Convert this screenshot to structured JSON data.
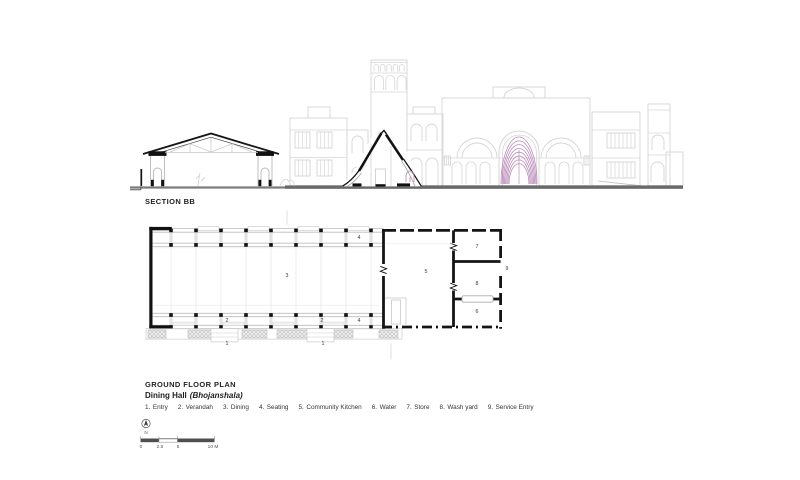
{
  "section": {
    "title": "SECTION BB"
  },
  "plan": {
    "title": "GROUND FLOOR PLAN",
    "subtitle_bold": "Dining Hall",
    "subtitle_italic": "(Bhojanshala)",
    "room_labels": [
      {
        "n": "4",
        "x": 359,
        "y": 238
      },
      {
        "n": "3",
        "x": 287,
        "y": 276
      },
      {
        "n": "5",
        "x": 426,
        "y": 272
      },
      {
        "n": "7",
        "x": 477,
        "y": 247
      },
      {
        "n": "9",
        "x": 507,
        "y": 269
      },
      {
        "n": "8",
        "x": 477,
        "y": 284
      },
      {
        "n": "6",
        "x": 477,
        "y": 312
      },
      {
        "n": "2",
        "x": 227,
        "y": 320.5
      },
      {
        "n": "2",
        "x": 322,
        "y": 320.5
      },
      {
        "n": "4",
        "x": 359,
        "y": 320.5
      },
      {
        "n": "1",
        "x": 227,
        "y": 344
      },
      {
        "n": "1",
        "x": 323,
        "y": 344
      }
    ]
  },
  "legend": {
    "items": [
      {
        "num": "1.",
        "label": "Entry"
      },
      {
        "num": "2.",
        "label": "Verandah"
      },
      {
        "num": "3.",
        "label": "Dining"
      },
      {
        "num": "4.",
        "label": "Seating"
      },
      {
        "num": "5.",
        "label": "Community Kitchen"
      },
      {
        "num": "6.",
        "label": "Water"
      },
      {
        "num": "7.",
        "label": "Store"
      },
      {
        "num": "8.",
        "label": "Wash yard"
      },
      {
        "num": "9.",
        "label": "Service Entry"
      }
    ]
  },
  "scale": {
    "north_label": "N",
    "marks": [
      {
        "t": "0",
        "x": 141
      },
      {
        "t": "2.5",
        "x": 160
      },
      {
        "t": "5",
        "x": 178
      },
      {
        "t": "10 M",
        "x": 213
      }
    ]
  },
  "colors": {
    "ink": "#1f1f1f",
    "elevation": "#d6d6d6",
    "faint": "#e3e3e3",
    "mid_gray": "#bdbdbd",
    "accent_magenta": "#b47fb3",
    "ground": "#6a6a6a"
  }
}
